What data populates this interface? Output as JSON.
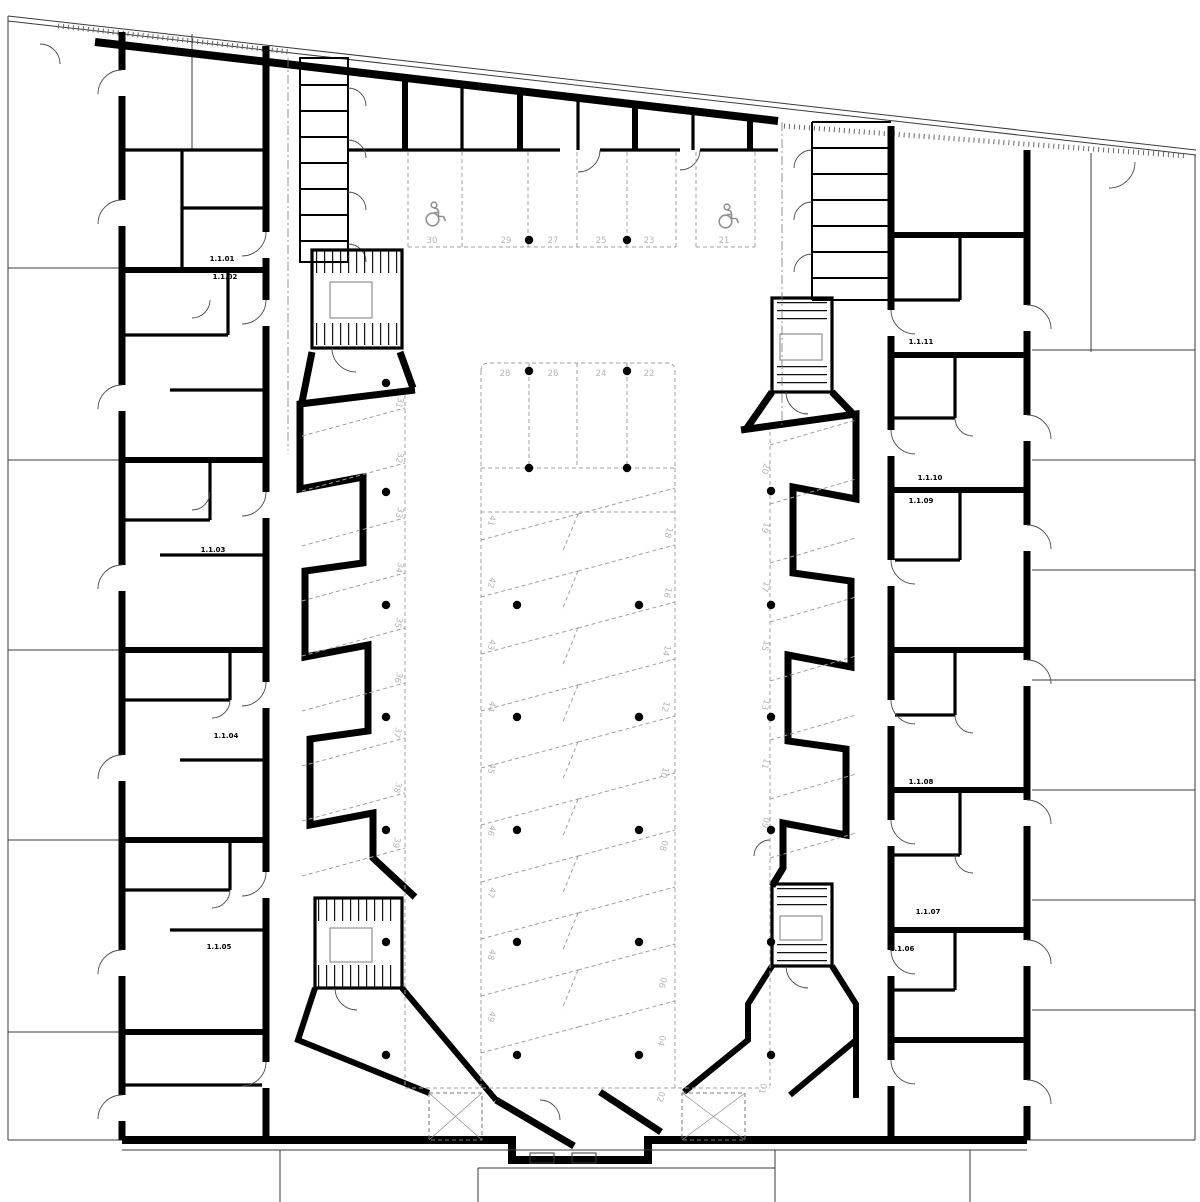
{
  "document": {
    "type": "architectural floor plan",
    "view": "residential block with central parking garage level"
  },
  "colors": {
    "background": "#ffffff",
    "walls": "#000000",
    "parking_lines": "#9f9f9f",
    "parking_numbers": "#b5b5b5",
    "unit_labels": "#000000",
    "wheelchair_icon": "#909090"
  },
  "units": {
    "labels": [
      "1.1.01",
      "1.1.02",
      "1.1.03",
      "1.1.04",
      "1.1.05",
      "1.1.06",
      "1.1.07",
      "1.1.08",
      "1.1.09",
      "1.1.10",
      "1.1.11"
    ]
  },
  "parking": {
    "top_row": [
      "30",
      "29",
      "27",
      "25",
      "23",
      "21"
    ],
    "middle_row": [
      "28",
      "26",
      "24",
      "22"
    ],
    "left_wall_row": [
      "31",
      "32",
      "33",
      "34",
      "35",
      "36",
      "37",
      "38",
      "39"
    ],
    "right_wall_row": [
      "20",
      "19",
      "17",
      "15",
      "13",
      "11",
      "09"
    ],
    "center_left_row": [
      "41",
      "42",
      "43",
      "44",
      "45",
      "46",
      "47",
      "48",
      "49"
    ],
    "center_right_row": [
      "18",
      "16",
      "14",
      "12",
      "10",
      "08",
      "06",
      "04",
      "02"
    ],
    "bottom_right_row": [
      "01"
    ],
    "accessible_spaces": [
      "30",
      "21"
    ]
  },
  "icons": {
    "wheelchair": "accessible-parking-icon"
  }
}
